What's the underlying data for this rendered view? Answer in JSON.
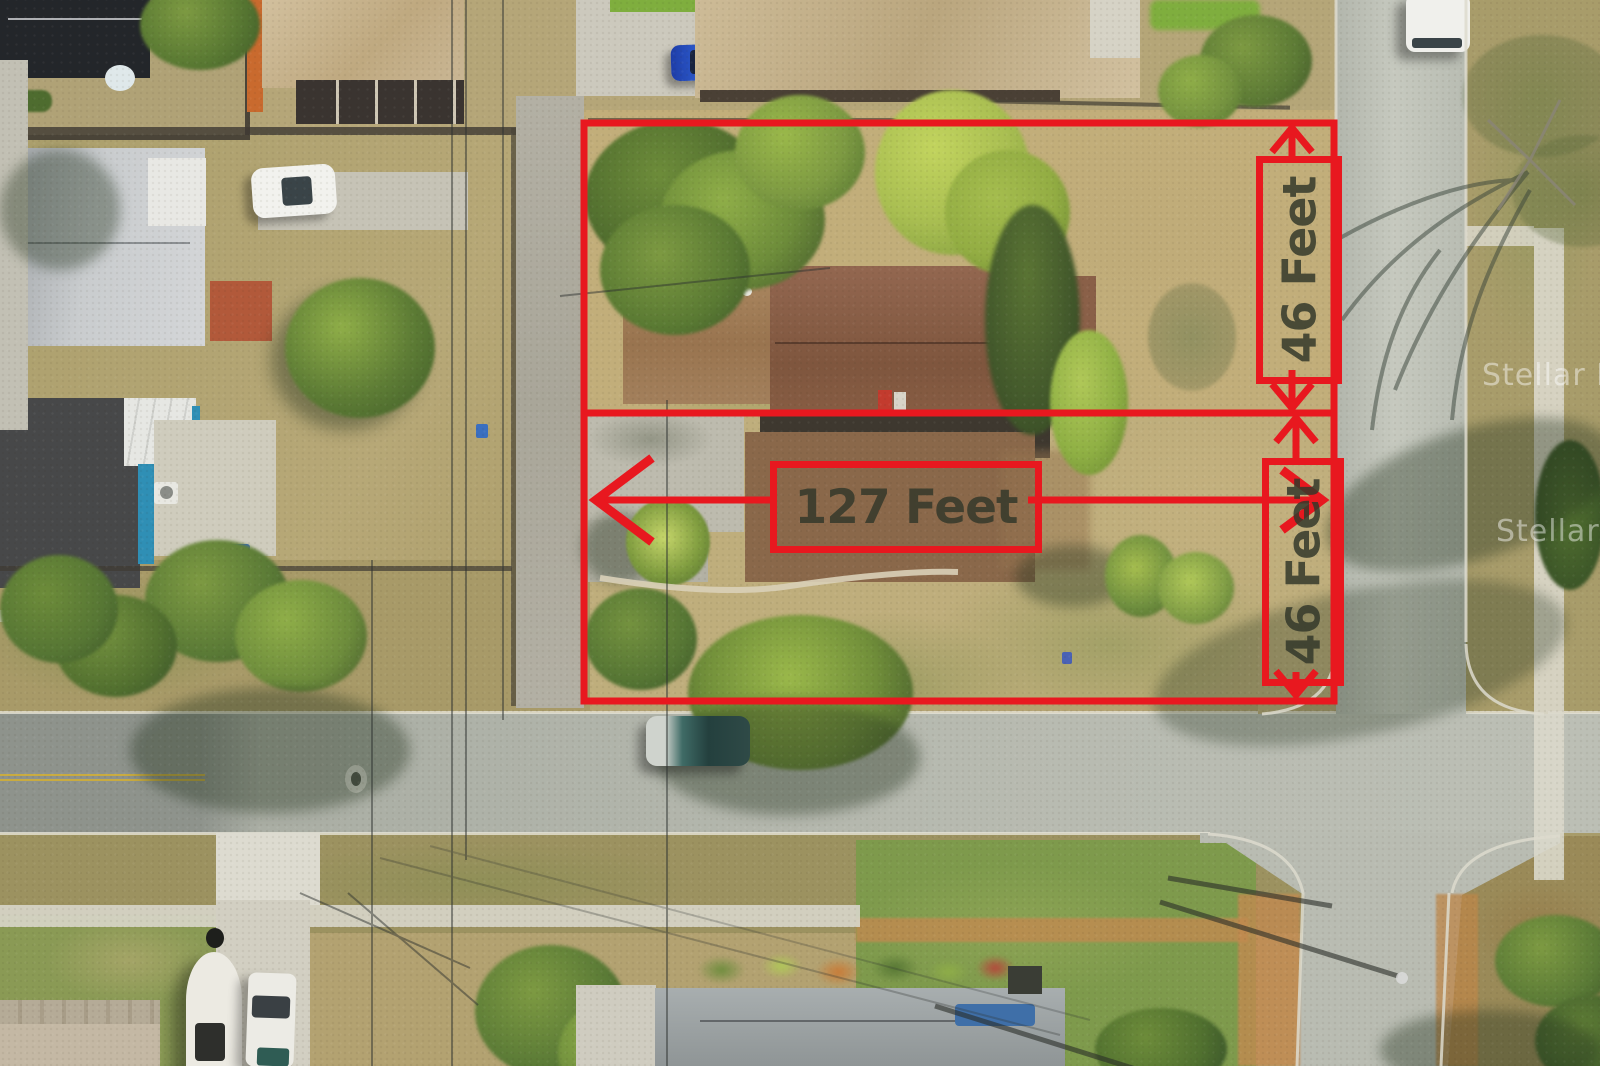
{
  "annotations": {
    "accent_color": "#e8181f",
    "label_text_color": "#343a2a",
    "dimensions": [
      {
        "id": "lot-width-north",
        "text": "46 Feet",
        "orientation": "vertical"
      },
      {
        "id": "lot-width-south",
        "text": "46 Feet",
        "orientation": "vertical"
      },
      {
        "id": "lot-depth",
        "text": "127 Feet",
        "orientation": "horizontal"
      }
    ]
  },
  "watermarks": [
    {
      "text": "Stellar MLS"
    },
    {
      "text": "Stellar MLS"
    }
  ]
}
